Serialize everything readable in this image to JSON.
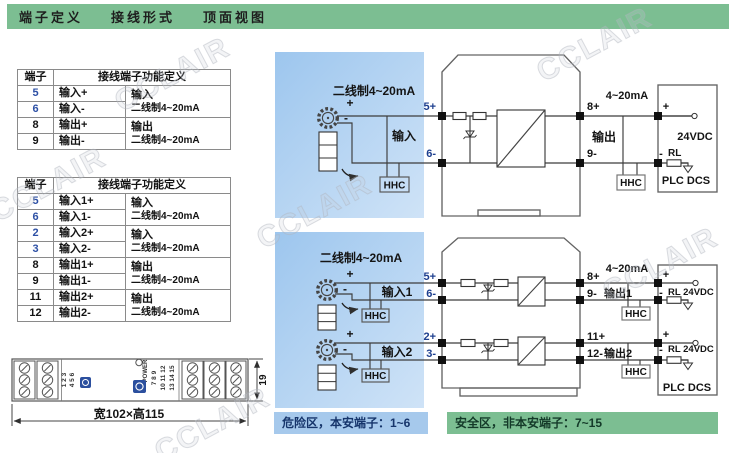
{
  "header": {
    "tabs": [
      "端子定义",
      "接线形式",
      "顶面视图"
    ]
  },
  "watermark": "CCLAIR",
  "table1": {
    "col_terminal": "端子",
    "col_function": "接线端子功能定义",
    "rows": [
      {
        "num": "5",
        "func": "输入+"
      },
      {
        "num": "6",
        "func": "输入-"
      },
      {
        "num": "8",
        "func": "输出+"
      },
      {
        "num": "9",
        "func": "输出-"
      }
    ],
    "groups": [
      {
        "line1": "输入",
        "line2": "二线制4~20mA"
      },
      {
        "line1": "输出",
        "line2": "二线制4~20mA"
      }
    ]
  },
  "table2": {
    "col_terminal": "端子",
    "col_function": "接线端子功能定义",
    "rows": [
      {
        "num": "5",
        "func": "输入1+"
      },
      {
        "num": "6",
        "func": "输入1-"
      },
      {
        "num": "2",
        "func": "输入2+"
      },
      {
        "num": "3",
        "func": "输入2-"
      },
      {
        "num": "8",
        "func": "输出1+"
      },
      {
        "num": "9",
        "func": "输出1-"
      },
      {
        "num": "11",
        "func": "输出2+"
      },
      {
        "num": "12",
        "func": "输出2-"
      }
    ],
    "groups": [
      {
        "line1": "输入",
        "line2": "二线制4~20mA"
      },
      {
        "line1": "输入",
        "line2": "二线制4~20mA"
      },
      {
        "line1": "输出",
        "line2": "二线制4~20mA"
      },
      {
        "line1": "输出",
        "line2": "二线制4~20mA"
      }
    ]
  },
  "device": {
    "power_label": "POWER",
    "terminal_group_left": [
      "1 2 3",
      "4 5 6"
    ],
    "terminal_group_right": [
      "7 8 9",
      "10 11 12",
      "13 14 15"
    ],
    "dim_depth": "19",
    "dim_size": "宽102×高115"
  },
  "diagram1": {
    "source_label": "二线制4~20mA",
    "plus": "+",
    "minus": "-",
    "input_label": "输入",
    "t5": "5+",
    "t6": "6-",
    "t8": "8+",
    "t9": "9-",
    "output_label": "输出",
    "output_current": "4~20mA",
    "hhc": "HHC",
    "psu_plus": "+",
    "psu_minus": "-",
    "psu_voltage": "24VDC",
    "load": "RL",
    "system": "PLC DCS"
  },
  "diagram2": {
    "source_label": "二线制4~20mA",
    "plus": "+",
    "minus": "-",
    "input1_label": "输入1",
    "input2_label": "输入2",
    "t5": "5+",
    "t6": "6-",
    "t2": "2+",
    "t3": "3-",
    "t8": "8+",
    "t9": "9-",
    "t11": "11+",
    "t12": "12-",
    "output1_label": "输出1",
    "output2_label": "输出2",
    "output_current": "4~20mA",
    "hhc": "HHC",
    "psu_plus": "+",
    "psu_minus": "-",
    "load_voltage": "RL 24VDC",
    "system": "PLC DCS"
  },
  "zones": {
    "hazard": "危险区，本安端子：1~6",
    "safe": "安全区，非本安端子：7~15"
  }
}
